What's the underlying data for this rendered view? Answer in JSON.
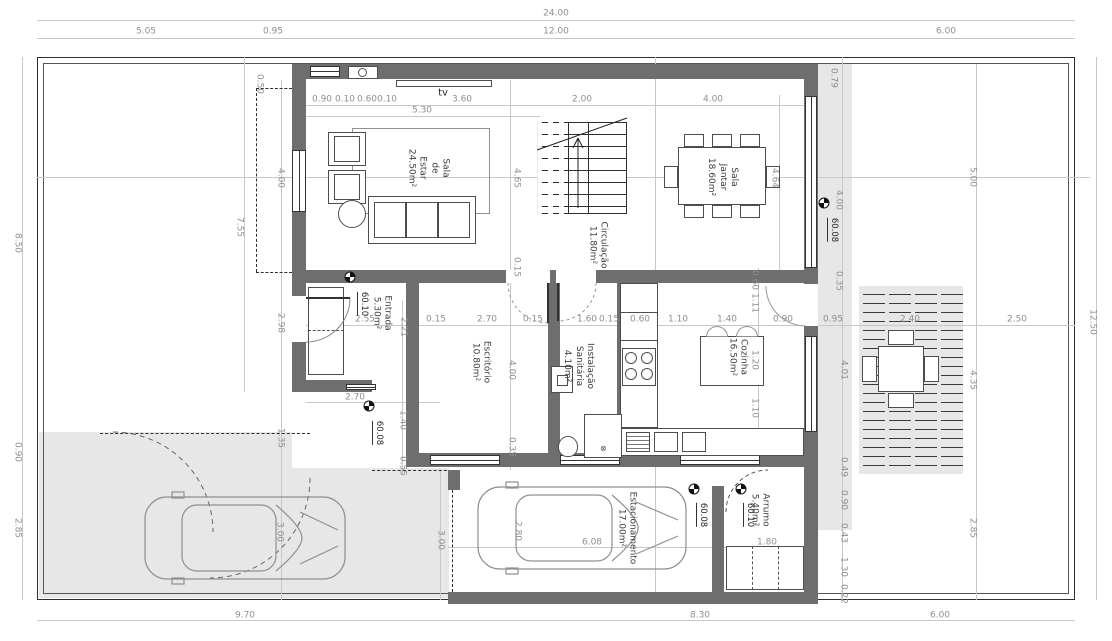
{
  "colors": {
    "wall": "#6e6e6e",
    "paving": "#e7e7e7",
    "dim_text": "#8f8f8f",
    "room_text": "#3d3d3d",
    "line": "#2f2f2f"
  },
  "labels": {
    "tv": "tv"
  },
  "rooms": [
    {
      "name": "Sala de Estar",
      "area": "24.50m²",
      "lines": [
        "Sala",
        "de",
        "Estar",
        "24.50m²"
      ],
      "x": 428,
      "y": 168
    },
    {
      "name": "Sala Jantar",
      "area": "18.60m²",
      "lines": [
        "Sala",
        "Jantar",
        "18.60m²"
      ],
      "x": 722,
      "y": 177
    },
    {
      "name": "Circulação",
      "area": "11.80m²",
      "lines": [
        "Circulação",
        "11.80m²"
      ],
      "x": 597,
      "y": 245
    },
    {
      "name": "Entrada",
      "area": "5.30m²",
      "lines": [
        "Entrada",
        "5.30m²"
      ],
      "x": 381,
      "y": 313
    },
    {
      "name": "Escritório",
      "area": "10.80m²",
      "lines": [
        "Escritório",
        "10.80m²"
      ],
      "x": 480,
      "y": 362
    },
    {
      "name": "Instalação Sanitária",
      "area": "4.10m²",
      "lines": [
        "Instalação",
        "Sanitária",
        "4.10m²"
      ],
      "x": 578,
      "y": 366
    },
    {
      "name": "Cozinha",
      "area": "16.50m²",
      "lines": [
        "Cozinha",
        "16.50m²"
      ],
      "x": 737,
      "y": 357
    },
    {
      "name": "Estacionamento",
      "area": "17.00m²",
      "lines": [
        "Estacionamento",
        "17.00m²"
      ],
      "x": 626,
      "y": 528
    },
    {
      "name": "Arrumo",
      "area": "5.40m²",
      "lines": [
        "Arrumo",
        "5.40m²"
      ],
      "x": 759,
      "y": 510
    }
  ],
  "levels": [
    {
      "value": "60.10",
      "mx": 350,
      "my": 277,
      "lx": 363,
      "ly": 304
    },
    {
      "value": "60.08",
      "mx": 369,
      "my": 406,
      "lx": 378,
      "ly": 433
    },
    {
      "value": "60.08",
      "mx": 824,
      "my": 203,
      "lx": 833,
      "ly": 230
    },
    {
      "value": "60.08",
      "mx": 694,
      "my": 489,
      "lx": 702,
      "ly": 515
    },
    {
      "value": "60.10",
      "mx": 741,
      "my": 489,
      "lx": 749,
      "ly": 515
    }
  ],
  "dims": [
    {
      "t": "24.00",
      "x": 556,
      "y": 14,
      "o": "h"
    },
    {
      "t": "5.05",
      "x": 146,
      "y": 32,
      "o": "h"
    },
    {
      "t": "0.95",
      "x": 273,
      "y": 32,
      "o": "h"
    },
    {
      "t": "12.00",
      "x": 556,
      "y": 32,
      "o": "h"
    },
    {
      "t": "6.00",
      "x": 946,
      "y": 32,
      "o": "h"
    },
    {
      "t": "0.90",
      "x": 322,
      "y": 100,
      "o": "h"
    },
    {
      "t": "0.10",
      "x": 345,
      "y": 100,
      "o": "h"
    },
    {
      "t": "0.60",
      "x": 367,
      "y": 100,
      "o": "h"
    },
    {
      "t": "0.10",
      "x": 387,
      "y": 100,
      "o": "h"
    },
    {
      "t": "3.60",
      "x": 462,
      "y": 100,
      "o": "h"
    },
    {
      "t": "5.30",
      "x": 422,
      "y": 111,
      "o": "h"
    },
    {
      "t": "2.00",
      "x": 582,
      "y": 100,
      "o": "h"
    },
    {
      "t": "4.00",
      "x": 713,
      "y": 100,
      "o": "h"
    },
    {
      "t": "0.50",
      "x": 259,
      "y": 84,
      "o": "v"
    },
    {
      "t": "0.79",
      "x": 833,
      "y": 78,
      "o": "v"
    },
    {
      "t": "8.50",
      "x": 17,
      "y": 243,
      "o": "v"
    },
    {
      "t": "0.90",
      "x": 17,
      "y": 452,
      "o": "v"
    },
    {
      "t": "2.85",
      "x": 17,
      "y": 528,
      "o": "v"
    },
    {
      "t": "7.55",
      "x": 239,
      "y": 227,
      "o": "v"
    },
    {
      "t": "4.00",
      "x": 280,
      "y": 178,
      "o": "v"
    },
    {
      "t": "2.98",
      "x": 280,
      "y": 323,
      "o": "v"
    },
    {
      "t": "1.35",
      "x": 280,
      "y": 438,
      "o": "v"
    },
    {
      "t": "3.00",
      "x": 279,
      "y": 532,
      "o": "v"
    },
    {
      "t": "4.65",
      "x": 516,
      "y": 178,
      "o": "v"
    },
    {
      "t": "0.15",
      "x": 516,
      "y": 267,
      "o": "v"
    },
    {
      "t": "4.00",
      "x": 511,
      "y": 370,
      "o": "v"
    },
    {
      "t": "0.35",
      "x": 511,
      "y": 447,
      "o": "v"
    },
    {
      "t": "4.64",
      "x": 774,
      "y": 178,
      "o": "v"
    },
    {
      "t": "2.55",
      "x": 365,
      "y": 320,
      "o": "h"
    },
    {
      "t": "2.21",
      "x": 403,
      "y": 327,
      "o": "v"
    },
    {
      "t": "0.15",
      "x": 436,
      "y": 320,
      "o": "h"
    },
    {
      "t": "2.70",
      "x": 487,
      "y": 320,
      "o": "h"
    },
    {
      "t": "0.15",
      "x": 533,
      "y": 320,
      "o": "h"
    },
    {
      "t": "1.60",
      "x": 587,
      "y": 320,
      "o": "h"
    },
    {
      "t": "0.15",
      "x": 609,
      "y": 320,
      "o": "h"
    },
    {
      "t": "0.60",
      "x": 640,
      "y": 320,
      "o": "h"
    },
    {
      "t": "1.10",
      "x": 678,
      "y": 320,
      "o": "h"
    },
    {
      "t": "1.40",
      "x": 727,
      "y": 320,
      "o": "h"
    },
    {
      "t": "0.90",
      "x": 783,
      "y": 320,
      "o": "h"
    },
    {
      "t": "0.95",
      "x": 833,
      "y": 320,
      "o": "h"
    },
    {
      "t": "2.40",
      "x": 910,
      "y": 320,
      "o": "h"
    },
    {
      "t": "2.50",
      "x": 1017,
      "y": 320,
      "o": "h"
    },
    {
      "t": "0.60",
      "x": 754,
      "y": 280,
      "o": "v"
    },
    {
      "t": "1.11",
      "x": 754,
      "y": 303,
      "o": "v"
    },
    {
      "t": "1.20",
      "x": 754,
      "y": 360,
      "o": "v"
    },
    {
      "t": "1.10",
      "x": 754,
      "y": 408,
      "o": "v"
    },
    {
      "t": "2.70",
      "x": 355,
      "y": 398,
      "o": "h"
    },
    {
      "t": "1.40",
      "x": 402,
      "y": 420,
      "o": "v"
    },
    {
      "t": "0.55",
      "x": 402,
      "y": 466,
      "o": "v"
    },
    {
      "t": "4.00",
      "x": 838,
      "y": 200,
      "o": "v"
    },
    {
      "t": "0.35",
      "x": 838,
      "y": 281,
      "o": "v"
    },
    {
      "t": "4.01",
      "x": 843,
      "y": 370,
      "o": "v"
    },
    {
      "t": "0.49",
      "x": 843,
      "y": 467,
      "o": "v"
    },
    {
      "t": "0.90",
      "x": 843,
      "y": 500,
      "o": "v"
    },
    {
      "t": "0.43",
      "x": 843,
      "y": 533,
      "o": "v"
    },
    {
      "t": "1.30",
      "x": 843,
      "y": 567,
      "o": "v"
    },
    {
      "t": "0.22",
      "x": 843,
      "y": 594,
      "o": "v"
    },
    {
      "t": "5.00",
      "x": 972,
      "y": 177,
      "o": "v"
    },
    {
      "t": "4.35",
      "x": 972,
      "y": 380,
      "o": "v"
    },
    {
      "t": "2.85",
      "x": 972,
      "y": 528,
      "o": "v"
    },
    {
      "t": "12.50",
      "x": 1092,
      "y": 322,
      "o": "v"
    },
    {
      "t": "2.80",
      "x": 517,
      "y": 531,
      "o": "v"
    },
    {
      "t": "6.08",
      "x": 592,
      "y": 543,
      "o": "h"
    },
    {
      "t": "3.00",
      "x": 440,
      "y": 540,
      "o": "v"
    },
    {
      "t": "1.80",
      "x": 767,
      "y": 543,
      "o": "h"
    },
    {
      "t": "9.70",
      "x": 245,
      "y": 616,
      "o": "h"
    },
    {
      "t": "8.30",
      "x": 700,
      "y": 616,
      "o": "h"
    },
    {
      "t": "6.00",
      "x": 940,
      "y": 616,
      "o": "h"
    }
  ]
}
